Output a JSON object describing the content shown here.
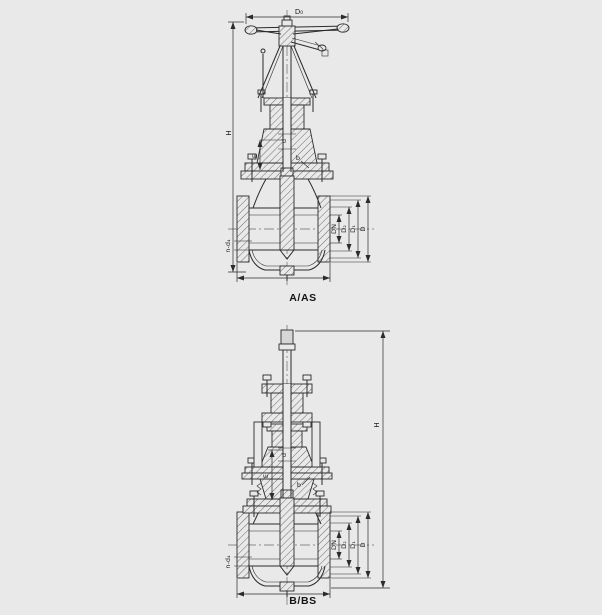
{
  "page": {
    "background": "#e9e9e9",
    "ink": "#2b2b2b"
  },
  "figures": [
    {
      "caption": "A/AS",
      "dims": {
        "d0": "D₀",
        "h": "H",
        "stem_d": "d",
        "e": "E",
        "b": "b",
        "dn": "DN",
        "d2": "D₂",
        "d1": "D₁",
        "d": "D",
        "bolt_holes": "n-d₄"
      }
    },
    {
      "caption": "B/BS",
      "dims": {
        "h": "H",
        "stem_d": "d",
        "e": "E",
        "b": "b",
        "dn": "DN",
        "d2": "D₂",
        "d1": "D₁",
        "d": "D",
        "bolt_holes": "n-d₄"
      }
    }
  ]
}
